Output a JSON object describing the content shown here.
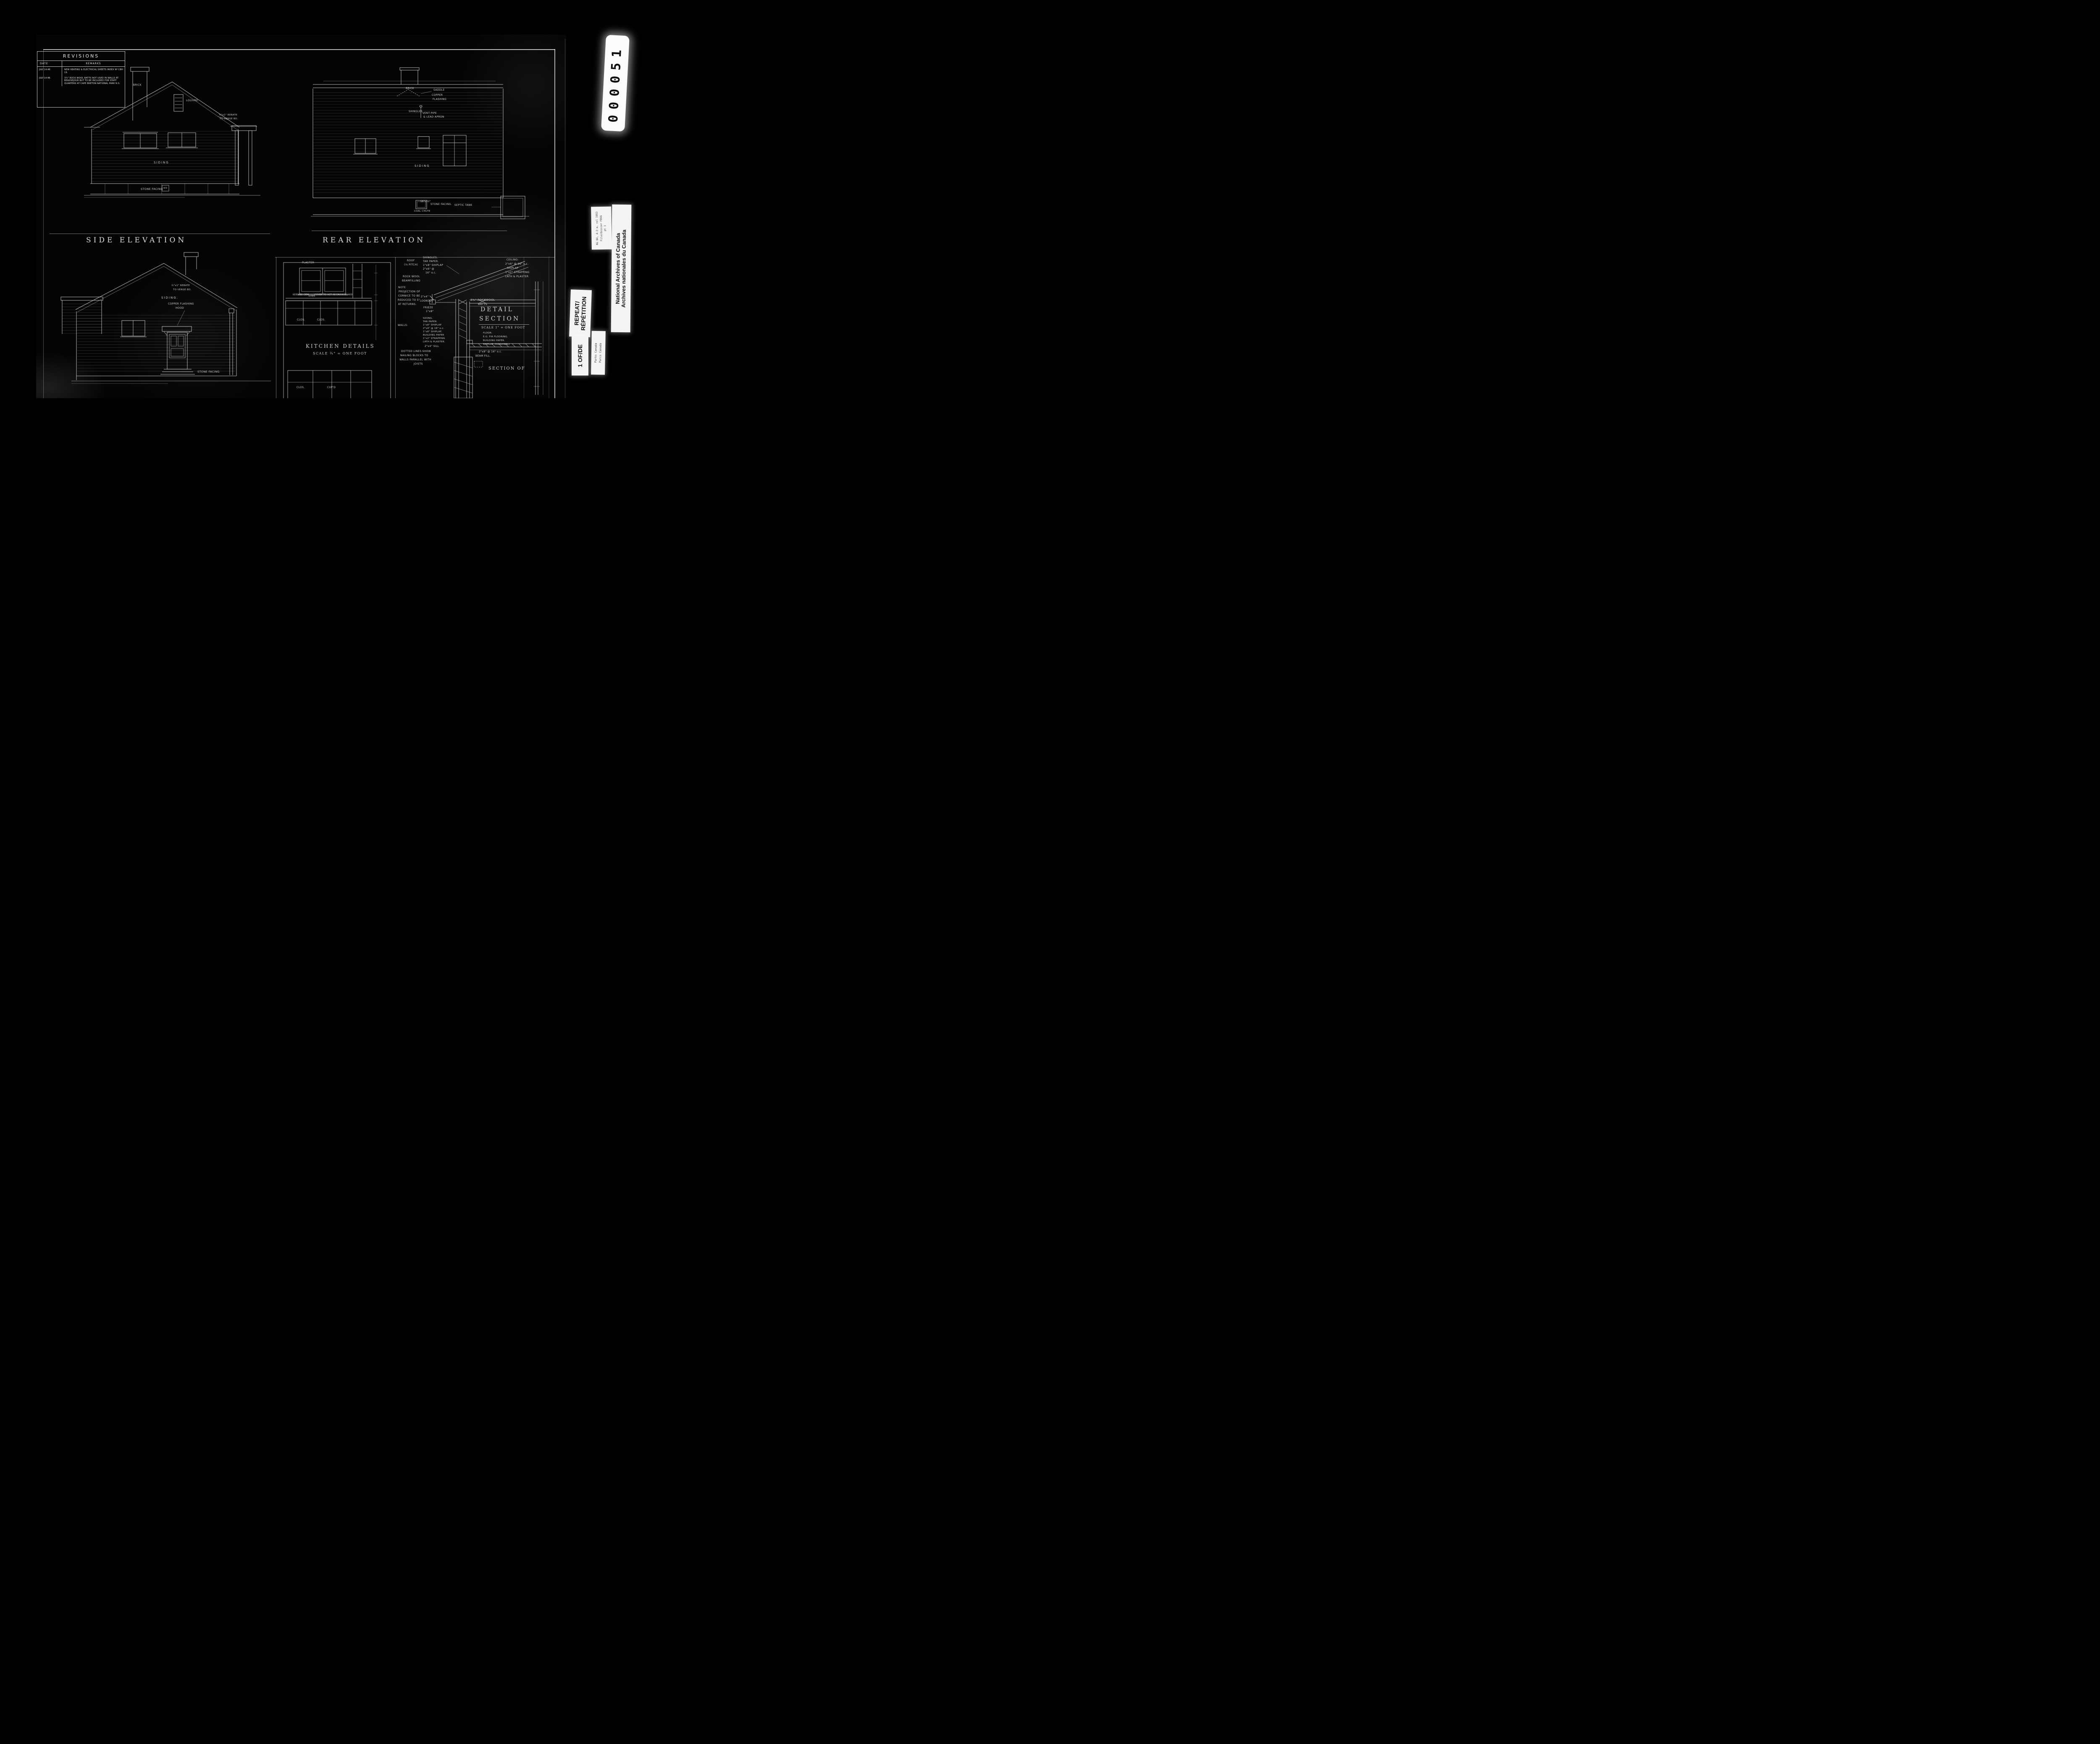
{
  "film": {
    "counter": "000051",
    "labels": {
      "small_top": [
        "RG 84, A-2-a, vol 1053",
        "File/dossier FB56",
        "pt 1"
      ],
      "archives": [
        "National Archives of Canada",
        "Archives nationales du Canada"
      ],
      "repeat": [
        "REPEAT/",
        "RÉPÉTITION"
      ],
      "frame": "1  OF/DE",
      "parks": [
        "Parks Canada",
        "Parcs Canada"
      ]
    }
  },
  "revisions": {
    "title": "REVISIONS",
    "col_date": "DATE",
    "col_remarks": "REMARKS",
    "rows": [
      {
        "date": "JULY 14.48.",
        "remarks": "NEW HEATING & ELECTRICAL SHEETS INDEX Nº CBH 19."
      },
      {
        "date": "JULY 14.48.",
        "remarks": "3¾\" ROCK WOOL BATTS NOT USED IN WALLS AT BEAUSEJOUR BUT TO BE INCLUDED FOR STAFF QUARTERS AT CAPE BRETON NATIONAL PARK N.S."
      }
    ]
  },
  "titles": {
    "side": "SIDE ELEVATION",
    "rear": "REAR ELEVATION"
  },
  "side": {
    "brick": "BRICK",
    "louvre": "LOUVRE.",
    "rebate": [
      "½\"x1\" REBATE",
      "TO VERGE BD."
    ],
    "siding": "SIDING",
    "stone": "STONE FACING",
    "wd": "W/D"
  },
  "rear": {
    "brick": "BRICK",
    "saddle": "SADDLE",
    "copper": [
      "COPPER",
      "FLASHING"
    ],
    "shingles": "SHINGLES",
    "vent": [
      "VENT PIPE",
      "& LEAD APRON"
    ],
    "siding": "SIDING",
    "coal": [
      "16\"x22\"",
      "COAL CHUTE"
    ],
    "stone": "STONE FACING.",
    "septic": "SEPTIC TANK"
  },
  "front": {
    "rebate": [
      "½\"x1\" REBATE",
      "TO VERGE BD."
    ],
    "siding": "SIDING.",
    "copper": [
      "COPPER FLASHING",
      "HOOD"
    ],
    "stone": "STONE FACING"
  },
  "kitchen": {
    "title": "KITCHEN DETAILS",
    "scale": "SCALE ¾\" = ONE FOOT",
    "plaster": "PLASTER",
    "keenes": "KEENES CEM.",
    "sink": "SINK",
    "drain": "COVER TO ACT AS DRAIN BOARD",
    "clos1": "CLOS.",
    "clos2": "CLOS.",
    "clos3": "CLOS.",
    "cupd": "CUP'D"
  },
  "detail": {
    "roof_label": [
      "ROOF",
      "(⅓ PITCH)"
    ],
    "roof_layers": [
      "SHINGLES.",
      "TAR PAPER.",
      "1\"x8\" SHIPLAP",
      "2\"x6\" @",
      "16\" o.c."
    ],
    "beamfill": [
      "ROCK WOOL",
      "BEAMFILLING"
    ],
    "note": [
      "NOTE",
      "PROJECTION OF",
      "CORNICE TO BE",
      "REDUCED TO 5\"",
      "AT RETURNS."
    ],
    "lookout": [
      "2\"x4\"",
      "LOOKOUT"
    ],
    "frieze": [
      "FRIEZE",
      "1\"x8\""
    ],
    "walls_label": "WALLS:",
    "wall_layers": [
      "SIDING.",
      "TAR PAPER.",
      "1\"x8\" SHIPLAP",
      "2\"x4\" @ 16\" o.c.",
      "1\"x8\" SHIPLAP.",
      "BUILDING PAPER",
      "1\"x2\" STRAPPING",
      "LATH & PLASTER."
    ],
    "sill": "2\"x4\" SILL",
    "dotted": [
      "DOTTED LINES SHOW",
      "NAILING BLOCKS TO",
      "WALLS PARALLEL WITH",
      "JOISTS"
    ],
    "ceiling": [
      "CEILING:",
      "2\"x6\" @ 16\" o.c.",
      "SHIPLAP",
      "1\"x2\" STRAPPING",
      "LATH & PLASTER"
    ],
    "batts": [
      "3¾\" ROCKWOOL",
      "BATTS"
    ],
    "title": [
      "DETAIL",
      "SECTION"
    ],
    "scale": "SCALE 1\" = ONE FOOT",
    "floor": [
      "FLOOR:",
      "E.G. FIR FLOORING.",
      "BUILDING PAPER.",
      "SHIPLAP (DIAGONAL)"
    ],
    "joists": "2\"x8\" @ 16\" o.c.",
    "beam": "BEAM FILL.",
    "section_of": "SECTION OF"
  }
}
